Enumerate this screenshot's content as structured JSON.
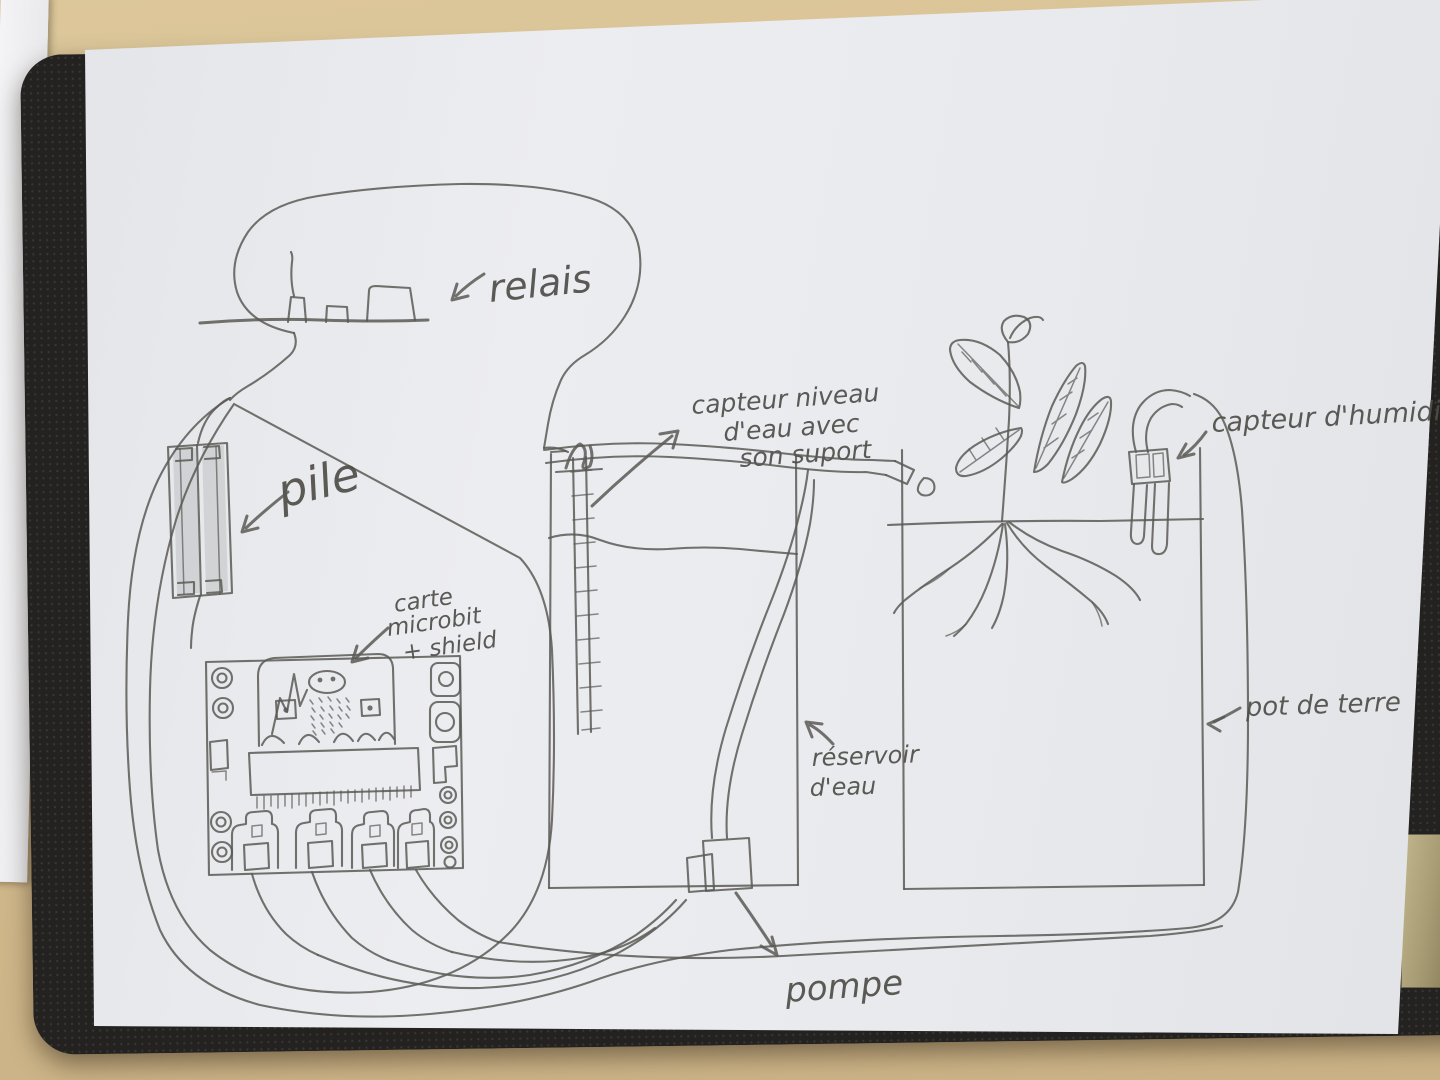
{
  "photo": {
    "laptop_brand": "Lenovo"
  },
  "colors": {
    "desk": "#d5bd8f",
    "laptop": "#242220",
    "paper": "#e8eaee",
    "pencil": "#5b5955",
    "sticker_gold": "#a79b74",
    "scrap_paper": "#f2f2f4"
  },
  "labels": {
    "relais": "relais",
    "pile": "pile",
    "carte": {
      "line1": "carte",
      "line2": "microbit",
      "line3": "+ shield"
    },
    "capteur_niveau": {
      "line1": "capteur niveau",
      "line2": "d'eau avec",
      "line3": "son suport"
    },
    "capteur_humidite": "capteur d'humidité",
    "reservoir": {
      "line1": "réservoir",
      "line2": "d'eau"
    },
    "pompe": "pompe",
    "pot": "pot de terre"
  }
}
